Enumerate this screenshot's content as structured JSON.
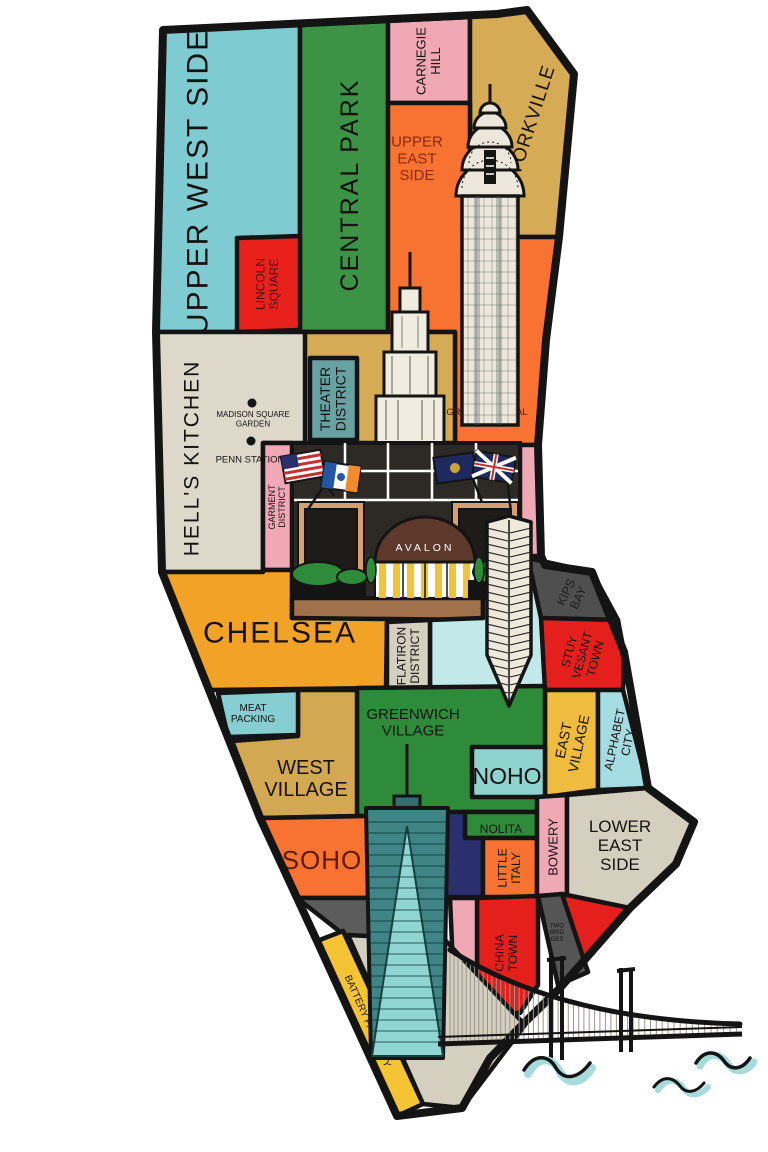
{
  "map": {
    "avalon_sign": "AVALON",
    "palette": {
      "water": "#a5dcda",
      "outline": "#141414",
      "label": "#151210"
    },
    "outline": "M 163,30 L 497,14 L 527,10 L 574,74 L 559,237 L 546,340 L 538,445 L 541,556 L 545,565 L 592,572 L 624,652 L 648,788 L 694,822 L 676,864 L 630,908 L 560,988 L 525,1022 L 490,1058 L 462,1108 L 397,1116 L 317,941 L 260,818 L 162,572 L 156,332 Z",
    "regions": [
      {
        "id": "upper-west-side",
        "label": [
          "UPPER WEST SIDE"
        ],
        "color": "#7eccd1",
        "pts": "163,30 300,25 300,332 156,332",
        "lx": 197,
        "ly": 182,
        "rot": -90,
        "fs": 30,
        "ls": 2
      },
      {
        "id": "central-park",
        "label": [
          "CENTRAL PARK"
        ],
        "color": "#3c9345",
        "pts": "300,25 388,21 388,332 300,332",
        "lx": 349,
        "ly": 185,
        "rot": -90,
        "fs": 25,
        "ls": 2
      },
      {
        "id": "lincoln-square",
        "label": [
          "LINCOLN",
          "SQUARE"
        ],
        "color": "#e8211d",
        "tc": "#4a0d0d",
        "pts": "237,238 300,236 300,330 237,332",
        "lx": 267,
        "ly": 284,
        "rot": -90,
        "fs": 12
      },
      {
        "id": "carnegie-hill",
        "label": [
          "CARNEGIE",
          "HILL"
        ],
        "color": "#f0a8b5",
        "pts": "388,21 470,17 470,103 388,103",
        "lx": 428,
        "ly": 61,
        "rot": -90,
        "fs": 13
      },
      {
        "id": "yorkville",
        "label": [
          "YORKVILLE"
        ],
        "color": "#d5ab55",
        "pts": "470,17 527,10 574,74 560,237 470,237",
        "lx": 531,
        "ly": 120,
        "rot": -72,
        "fs": 19,
        "ls": 1
      },
      {
        "id": "upper-east-side",
        "label": [
          "UPPER",
          "EAST",
          "SIDE"
        ],
        "color": "#f87331",
        "tc": "#8a2a0a",
        "pts": "388,103 470,103 470,237 560,237 546,340 538,445 455,445 455,332 388,332",
        "lx": 417,
        "ly": 158,
        "fs": 15
      },
      {
        "id": "midtown",
        "label": [],
        "color": "#d5ab55",
        "pts": "305,332 455,332 455,443 292,443"
      },
      {
        "id": "hells-kitchen",
        "label": [
          "HELL'S KITCHEN"
        ],
        "color": "#ddd8ca",
        "pts": "156,332 305,332 305,443 263,443 263,572 162,572",
        "lx": 191,
        "ly": 458,
        "rot": -90,
        "fs": 21,
        "ls": 2
      },
      {
        "id": "theater-district",
        "label": [
          "THEATER",
          "DISTRICT"
        ],
        "color": "#69a1a3",
        "pts": "310,358 357,358 357,440 310,440",
        "lx": 333,
        "ly": 399,
        "rot": -90,
        "fs": 14
      },
      {
        "id": "garment-district",
        "label": [
          "GARMENT",
          "DISTRICT"
        ],
        "color": "#f0a8b5",
        "pts": "263,443 292,443 292,570 263,570",
        "lx": 277,
        "ly": 507,
        "rot": -90,
        "fs": 9
      },
      {
        "id": "pink-east-strip",
        "label": [],
        "color": "#f0a8b5",
        "pts": "520,445 538,445 541,560 520,560"
      },
      {
        "id": "chelsea",
        "label": [
          "CHELSEA"
        ],
        "color": "#f2a227",
        "pts": "162,572 263,572 263,570 292,570 292,618 387,618 386,688 209,690",
        "lx": 280,
        "ly": 632,
        "fs": 30,
        "ls": 2
      },
      {
        "id": "avalon-forecourt",
        "label": [],
        "color": "#a0714a",
        "pts": "292,598 483,598 483,620 292,618"
      },
      {
        "id": "gramercy",
        "label": [],
        "color": "#c2e9ea",
        "pts": "430,620 483,618 483,598 520,598 520,556 541,556 546,620 545,688 430,688"
      },
      {
        "id": "flatiron-district",
        "label": [
          "FLATIRON",
          "DISTRICT"
        ],
        "color": "#d5cfc0",
        "pts": "387,622 430,620 430,688 387,688",
        "lx": 408,
        "ly": 656,
        "rot": -90,
        "fs": 12
      },
      {
        "id": "kips-bay",
        "label": [
          "KIPS",
          "BAY"
        ],
        "color": "#4f4f4f",
        "tc": "#1c1c1c",
        "pts": "528,558 592,572 618,620 541,618",
        "lx": 572,
        "ly": 595,
        "rot": -65,
        "fs": 12
      },
      {
        "id": "stuyvesant-town",
        "label": [
          "STUY",
          "VESANT",
          "TOWN"
        ],
        "color": "#e41f1c",
        "pts": "541,618 618,620 624,652 623,690 545,690",
        "lx": 582,
        "ly": 655,
        "rot": -75,
        "fs": 12
      },
      {
        "id": "east-village",
        "label": [
          "EAST",
          "VILLAGE"
        ],
        "color": "#f0bc3f",
        "pts": "545,690 598,690 598,790 545,797",
        "lx": 571,
        "ly": 742,
        "rot": -78,
        "fs": 14
      },
      {
        "id": "alphabet-city",
        "label": [
          "ALPHABET",
          "CITY"
        ],
        "color": "#a5dce2",
        "pts": "598,690 623,690 648,788 598,790",
        "lx": 621,
        "ly": 741,
        "rot": -78,
        "fs": 12
      },
      {
        "id": "greenwich-village",
        "label": [
          "GREENWICH",
          "VILLAGE"
        ],
        "color": "#2e8b3a",
        "pts": "357,688 545,686 545,812 465,812 370,816 357,816",
        "lx": 413,
        "ly": 722,
        "fs": 15
      },
      {
        "id": "noho",
        "label": [
          "NOHO"
        ],
        "color": "#8ed3cd",
        "pts": "472,747 545,747 545,797 472,797",
        "lx": 507,
        "ly": 776,
        "fs": 23
      },
      {
        "id": "west-village",
        "label": [
          "WEST",
          "VILLAGE"
        ],
        "color": "#d2a852",
        "pts": "298,690 357,690 357,816 262,818 232,741 298,736",
        "lx": 306,
        "ly": 778,
        "fs": 20
      },
      {
        "id": "meatpacking",
        "label": [
          "MEAT",
          "PACKING"
        ],
        "color": "#86ced2",
        "pts": "218,693 298,690 298,735 228,737",
        "lx": 253,
        "ly": 713,
        "fs": 10
      },
      {
        "id": "nolita",
        "label": [
          "NOLITA"
        ],
        "color": "#2e8b3a",
        "pts": "465,812 537,812 537,838 465,838",
        "lx": 501,
        "ly": 829,
        "fs": 12
      },
      {
        "id": "navy-block",
        "label": [],
        "color": "#2a2f6e",
        "pts": "445,812 465,812 465,838 483,838 483,897 445,897"
      },
      {
        "id": "little-italy",
        "label": [
          "LITTLE",
          "ITALY"
        ],
        "color": "#f87331",
        "pts": "483,838 537,838 537,897 483,897",
        "lx": 509,
        "ly": 868,
        "rot": -90,
        "fs": 12
      },
      {
        "id": "bowery",
        "label": [
          "BOWERY"
        ],
        "color": "#f0a8b5",
        "pts": "537,797 567,795 567,897 537,897",
        "lx": 553,
        "ly": 847,
        "rot": -90,
        "fs": 13
      },
      {
        "id": "lower-east-side",
        "label": [
          "LOWER",
          "EAST",
          "SIDE"
        ],
        "color": "#d5cfc0",
        "pts": "567,795 648,788 694,822 676,864 630,908 567,908",
        "lx": 620,
        "ly": 845,
        "fs": 17
      },
      {
        "id": "soho",
        "label": [
          "SOHO"
        ],
        "color": "#f87331",
        "tc": "#5b1c0c",
        "pts": "262,818 368,816 368,898 297,898",
        "lx": 322,
        "ly": 860,
        "fs": 26,
        "ls": 1
      },
      {
        "id": "tribeca",
        "label": [],
        "color": "#5c5c5c",
        "pts": "297,898 445,898 445,975 348,938"
      },
      {
        "id": "east-red",
        "label": [],
        "color": "#e41f1c",
        "pts": "562,894 630,908 560,988"
      },
      {
        "id": "chinatown",
        "label": [
          "CHINA",
          "TOWN"
        ],
        "color": "#e41f1c",
        "pts": "477,898 538,896 538,985 520,1013 477,1013",
        "lx": 506,
        "ly": 953,
        "rot": -90,
        "fs": 12
      },
      {
        "id": "pink-west-strip",
        "label": [],
        "color": "#f0a8b5",
        "pts": "450,898 477,898 477,1013 455,1013"
      },
      {
        "id": "two-bridges",
        "label": [
          "TWO",
          "BRID",
          "GES"
        ],
        "color": "#555555",
        "pts": "538,896 562,894 588,972 558,985",
        "lx": 557,
        "ly": 932,
        "fs": 6
      },
      {
        "id": "fidi",
        "label": [],
        "color": "#d5cfc0",
        "pts": "348,935 445,940 525,1025 462,1108 423,1104"
      },
      {
        "id": "battery-park-city",
        "label": [
          "BATTERY PARK CITY"
        ],
        "color": "#f5c435",
        "pts": "317,941 343,931 423,1104 397,1116",
        "lx": 368,
        "ly": 1021,
        "rot": 66,
        "fs": 10
      }
    ],
    "landmarks": [
      {
        "id": "madison-square-garden",
        "label": [
          "MADISON SQUARE",
          "GARDEN"
        ],
        "dot_x": 252,
        "dot_y": 403,
        "lx": 253,
        "ly": 419,
        "fs": 8
      },
      {
        "id": "penn-station",
        "label": [
          "PENN STATION"
        ],
        "dot_x": 251,
        "dot_y": 441,
        "lx": 250,
        "ly": 459,
        "fs": 9.5
      },
      {
        "id": "grand-central-terminal",
        "label": [
          "GRAND CENTRAL",
          "TERMINAL"
        ],
        "dot_x": 486,
        "dot_y": 398,
        "lx": 487,
        "ly": 417,
        "fs": 9.5,
        "tc": "#4a1205"
      }
    ]
  }
}
